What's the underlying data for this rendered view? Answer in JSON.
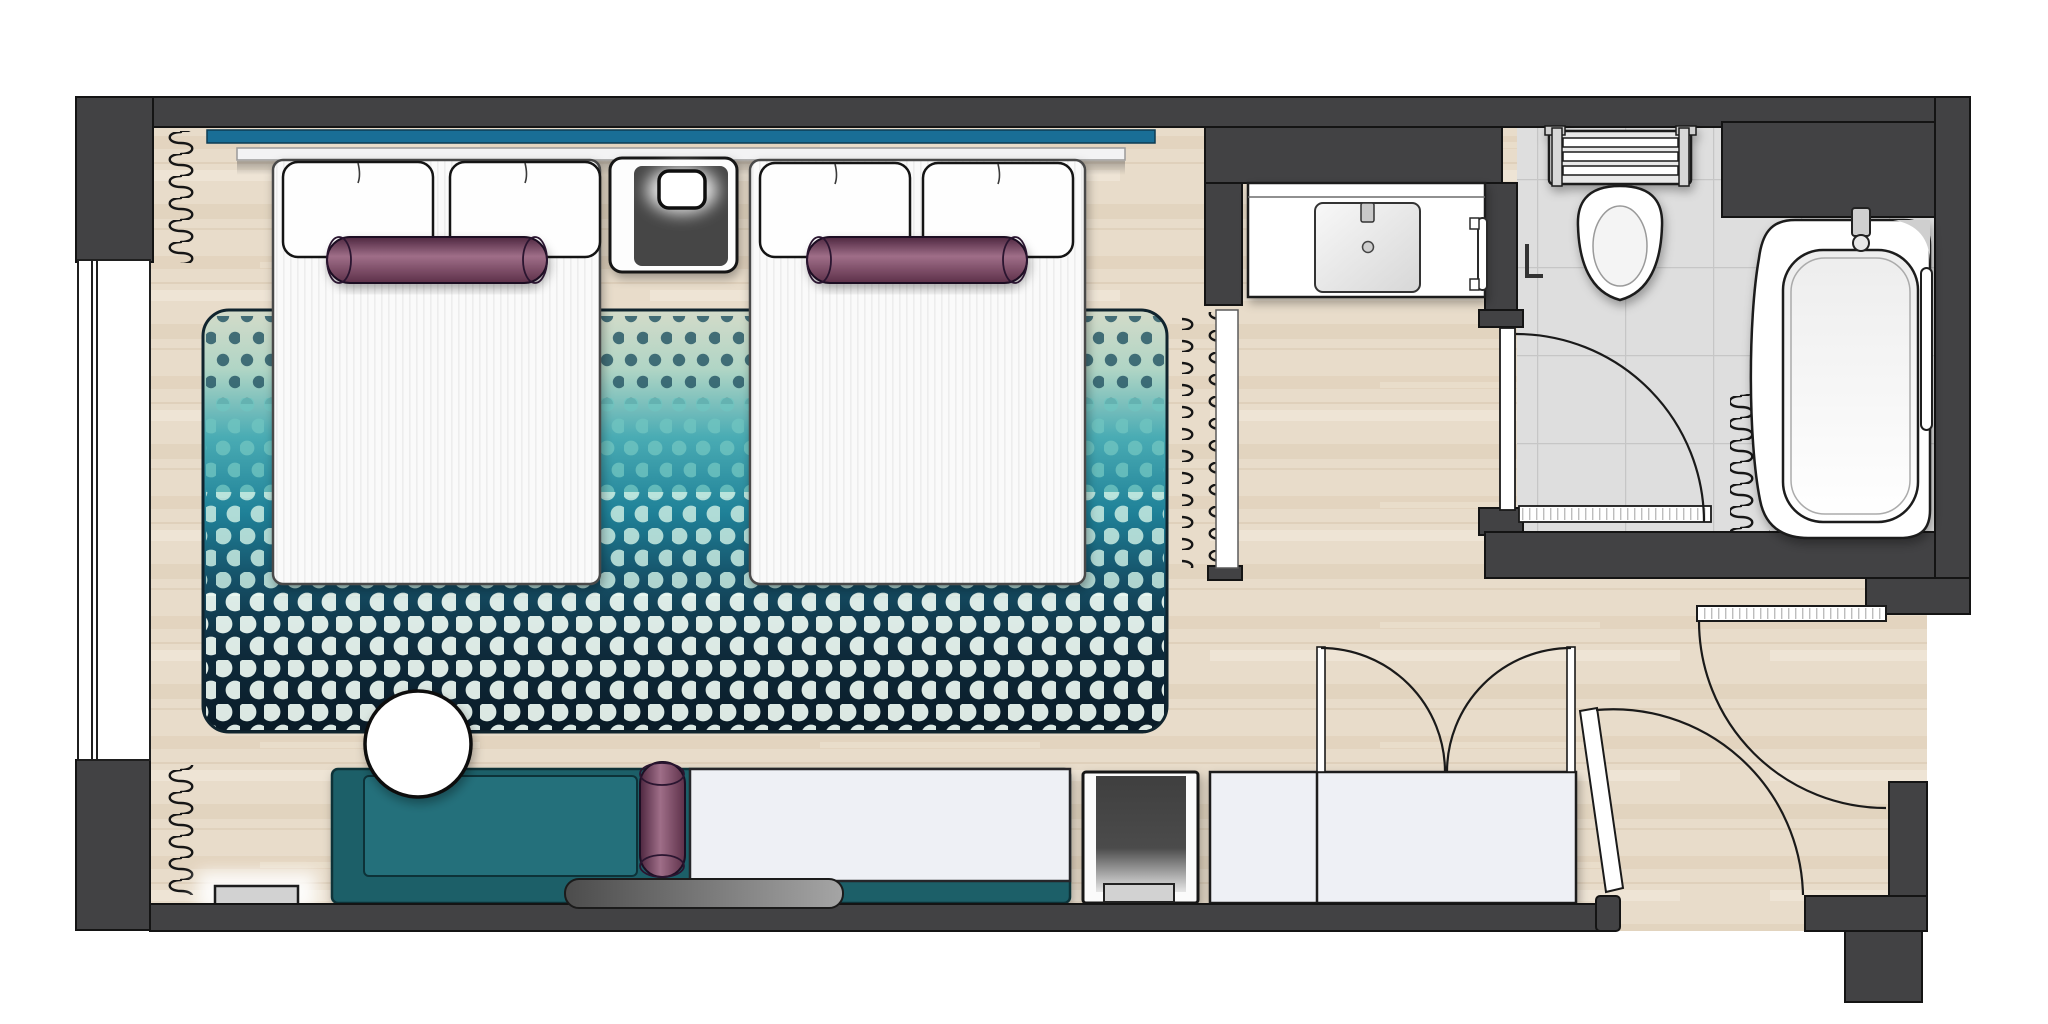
{
  "meta": {
    "kind": "architectural-floor-plan",
    "subject": "hotel-twin-guest-room-top-view",
    "rooms": [
      "bedroom",
      "entry-hallway",
      "bathroom"
    ]
  },
  "palette": {
    "wall": "#424244",
    "outline": "#161616",
    "floor_wood": "#e8dcca",
    "wood_streak": "#ddcdb6",
    "wood_light": "#f2e8da",
    "tile": "#dedede",
    "tile_line": "#c6c6c6",
    "headboard": "#196e96",
    "shelf": "#f3f3f4",
    "rug_c1": "#d4dbc9",
    "rug_c2": "#4aacb4",
    "rug_c3": "#155067",
    "rug_c4": "#0a1a26",
    "dot1": "#2a5a68",
    "dot2": "#6fc4c0",
    "dot3": "#c9ece2",
    "dot4": "#eefaf3",
    "mattress": "#fafafa",
    "pillow": "#fefefe",
    "plum_dark": "#4e2740",
    "plum": "#8d5873",
    "plum_deep": "#5d3049",
    "sofa": "#1e5f68",
    "sofa_inner": "#24707b",
    "sofa_edge": "#0d3238",
    "white_furniture": "#eef0f5",
    "cabinet_dark": "#464646",
    "tray": "#d2d2d2",
    "bar_dark": "#545454",
    "bar_light": "#9f9f9f",
    "fixture_white": "#ffffff",
    "shade": "#cfcfcf",
    "window": "#ffffff",
    "glow": "#ffffff"
  },
  "elements": [
    "outer-walls",
    "window",
    "area-rug",
    "headboard-panel",
    "display-shelf",
    "twin-bed-left",
    "twin-bed-right",
    "pillows",
    "bolster-cushions",
    "nightstand",
    "table-lamp",
    "radiator-coil-top-left",
    "radiator-coil-bottom-left",
    "radiator-coil-divider",
    "radiator-coil-bathroom",
    "round-side-table",
    "daybed-sofa",
    "seat-bolster",
    "work-console",
    "storage-bench",
    "floor-vent",
    "minibar-cabinet",
    "minibar-tray",
    "wardrobe",
    "wardrobe-door-leaves",
    "wardrobe-swing-arcs",
    "entry-door-leaf",
    "entry-door-swing-arc",
    "corridor-door-leaf",
    "corridor-door-swing-arc",
    "bathroom-door-leaf",
    "bathroom-door-threshold",
    "bathroom-door-swing-arc",
    "vanity-counter",
    "vanity-sink",
    "sink-faucet",
    "towel-rail",
    "toilet-cistern-rack",
    "toilet-bowl",
    "toilet-roll-holder",
    "bathtub",
    "tub-faucet",
    "tub-grab-rail",
    "tile-floor",
    "wood-floor"
  ]
}
